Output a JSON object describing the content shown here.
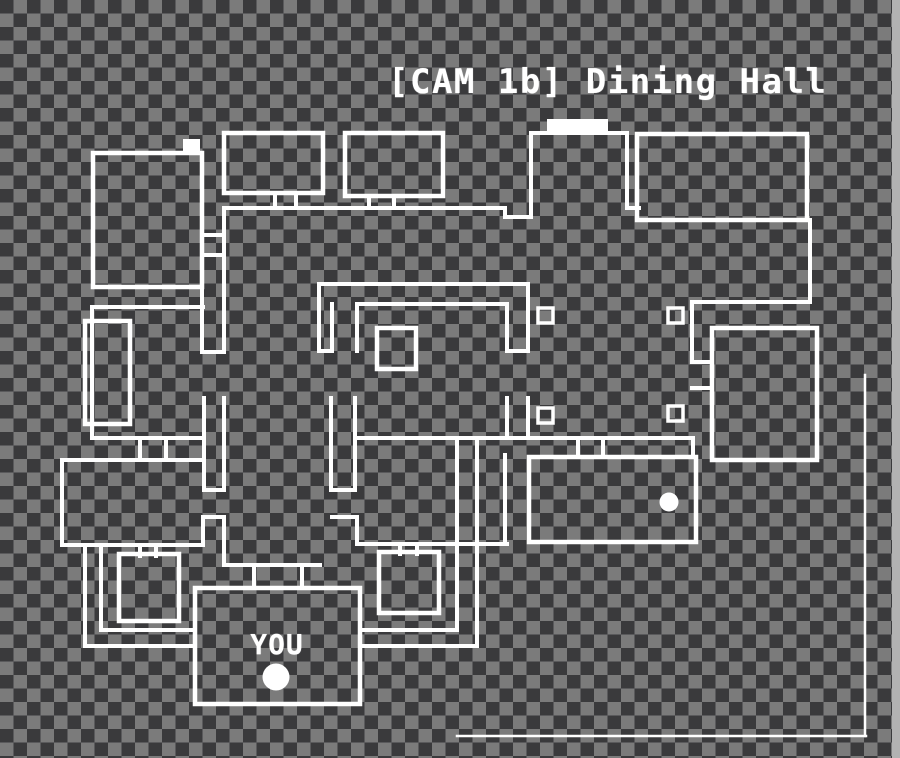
{
  "header": {
    "title": "[CAM 1b] Dining Hall"
  },
  "colors": {
    "checker_dark": "#3a3a3c",
    "checker_light": "#7b7b7b",
    "wall": "#ffffff",
    "text": "#ffffff",
    "edge_band": "#b2b2b2"
  },
  "map": {
    "you_label": "YOU",
    "rooms": [
      {
        "name": "room-top-left",
        "x": 93,
        "y": 153,
        "w": 109,
        "h": 134
      },
      {
        "name": "room-top-a",
        "x": 224,
        "y": 133,
        "w": 99,
        "h": 60
      },
      {
        "name": "room-top-b",
        "x": 345,
        "y": 133,
        "w": 98,
        "h": 63
      },
      {
        "name": "room-top-right",
        "x": 637,
        "y": 134,
        "w": 170,
        "h": 86
      },
      {
        "name": "room-right",
        "x": 712,
        "y": 328,
        "w": 105,
        "h": 132
      },
      {
        "name": "room-lower-right",
        "x": 529,
        "y": 457,
        "w": 167,
        "h": 85
      },
      {
        "name": "room-office",
        "x": 195,
        "y": 588,
        "w": 165,
        "h": 116
      },
      {
        "name": "closet-left",
        "x": 85,
        "y": 321,
        "w": 45,
        "h": 103
      },
      {
        "name": "room-lower-left",
        "x": 119,
        "y": 554,
        "w": 60,
        "h": 67
      },
      {
        "name": "room-lower-middle",
        "x": 379,
        "y": 552,
        "w": 60,
        "h": 61
      },
      {
        "name": "table-square",
        "x": 377,
        "y": 328,
        "w": 39,
        "h": 41
      }
    ],
    "small_squares": [
      {
        "name": "wall-block",
        "x": 538,
        "y": 308,
        "s": 15
      },
      {
        "name": "wall-block",
        "x": 668,
        "y": 308,
        "s": 15
      },
      {
        "name": "wall-block",
        "x": 538,
        "y": 408,
        "s": 15
      },
      {
        "name": "wall-block",
        "x": 668,
        "y": 406,
        "s": 15
      }
    ],
    "walls": [
      [
        225,
        208,
        505,
        208
      ],
      [
        505,
        208,
        505,
        217
      ],
      [
        505,
        217,
        531,
        217
      ],
      [
        531,
        217,
        531,
        133
      ],
      [
        531,
        133,
        627,
        133
      ],
      [
        627,
        133,
        627,
        208
      ],
      [
        627,
        208,
        639,
        208
      ],
      [
        275,
        193,
        275,
        208
      ],
      [
        296,
        193,
        296,
        208
      ],
      [
        369,
        196,
        369,
        208
      ],
      [
        394,
        196,
        394,
        208
      ],
      [
        810,
        220,
        810,
        302
      ],
      [
        810,
        302,
        692,
        302
      ],
      [
        692,
        302,
        692,
        362
      ],
      [
        692,
        362,
        712,
        362
      ],
      [
        692,
        388,
        712,
        388
      ],
      [
        202,
        287,
        202,
        352
      ],
      [
        224,
        208,
        224,
        352
      ],
      [
        202,
        235,
        224,
        235
      ],
      [
        202,
        255,
        224,
        255
      ],
      [
        202,
        352,
        224,
        352
      ],
      [
        204,
        398,
        204,
        490
      ],
      [
        224,
        398,
        224,
        490
      ],
      [
        204,
        490,
        224,
        490
      ],
      [
        92,
        307,
        203,
        307
      ],
      [
        92,
        307,
        92,
        438
      ],
      [
        92,
        438,
        202,
        438
      ],
      [
        140,
        438,
        140,
        460
      ],
      [
        166,
        438,
        166,
        460
      ],
      [
        62,
        460,
        203,
        460
      ],
      [
        62,
        460,
        62,
        545
      ],
      [
        62,
        545,
        203,
        545
      ],
      [
        203,
        545,
        203,
        517
      ],
      [
        203,
        517,
        224,
        517
      ],
      [
        224,
        517,
        224,
        565
      ],
      [
        224,
        565,
        320,
        565
      ],
      [
        254,
        565,
        254,
        588
      ],
      [
        302,
        565,
        302,
        588
      ],
      [
        85,
        545,
        85,
        646
      ],
      [
        101,
        545,
        101,
        630
      ],
      [
        85,
        646,
        195,
        646
      ],
      [
        101,
        630,
        195,
        630
      ],
      [
        360,
        630,
        457,
        630
      ],
      [
        360,
        646,
        477,
        646
      ],
      [
        457,
        438,
        457,
        630
      ],
      [
        477,
        438,
        477,
        646
      ],
      [
        319,
        284,
        528,
        284
      ],
      [
        319,
        284,
        319,
        351
      ],
      [
        319,
        351,
        332,
        351
      ],
      [
        332,
        304,
        332,
        351
      ],
      [
        357,
        304,
        507,
        304
      ],
      [
        357,
        304,
        357,
        351
      ],
      [
        507,
        304,
        507,
        351
      ],
      [
        528,
        284,
        528,
        351
      ],
      [
        507,
        351,
        528,
        351
      ],
      [
        331,
        398,
        331,
        490
      ],
      [
        355,
        398,
        355,
        490
      ],
      [
        331,
        490,
        355,
        490
      ],
      [
        507,
        398,
        507,
        438
      ],
      [
        528,
        398,
        528,
        438
      ],
      [
        357,
        438,
        693,
        438
      ],
      [
        578,
        438,
        578,
        457
      ],
      [
        603,
        438,
        603,
        457
      ],
      [
        693,
        438,
        693,
        457
      ],
      [
        505,
        455,
        505,
        542
      ],
      [
        332,
        517,
        357,
        517
      ],
      [
        357,
        517,
        357,
        544
      ],
      [
        357,
        544,
        507,
        544
      ],
      [
        400,
        544,
        400,
        554
      ],
      [
        417,
        544,
        417,
        554
      ],
      [
        140,
        545,
        140,
        556
      ],
      [
        156,
        545,
        156,
        556
      ]
    ],
    "filled_rects": [
      {
        "name": "stage-door-highlight",
        "x": 547,
        "y": 119,
        "w": 61,
        "h": 14
      },
      {
        "name": "corner-door-highlight",
        "x": 183,
        "y": 139,
        "w": 17,
        "h": 14
      }
    ],
    "dots": [
      {
        "name": "you-position-dot",
        "cx": 276,
        "cy": 677,
        "r": 13.5
      },
      {
        "name": "subject-dot",
        "cx": 669,
        "cy": 502,
        "r": 9.5
      }
    ],
    "frame_lines": [
      [
        865,
        375,
        865,
        736
      ],
      [
        457,
        736,
        866,
        736
      ]
    ]
  }
}
